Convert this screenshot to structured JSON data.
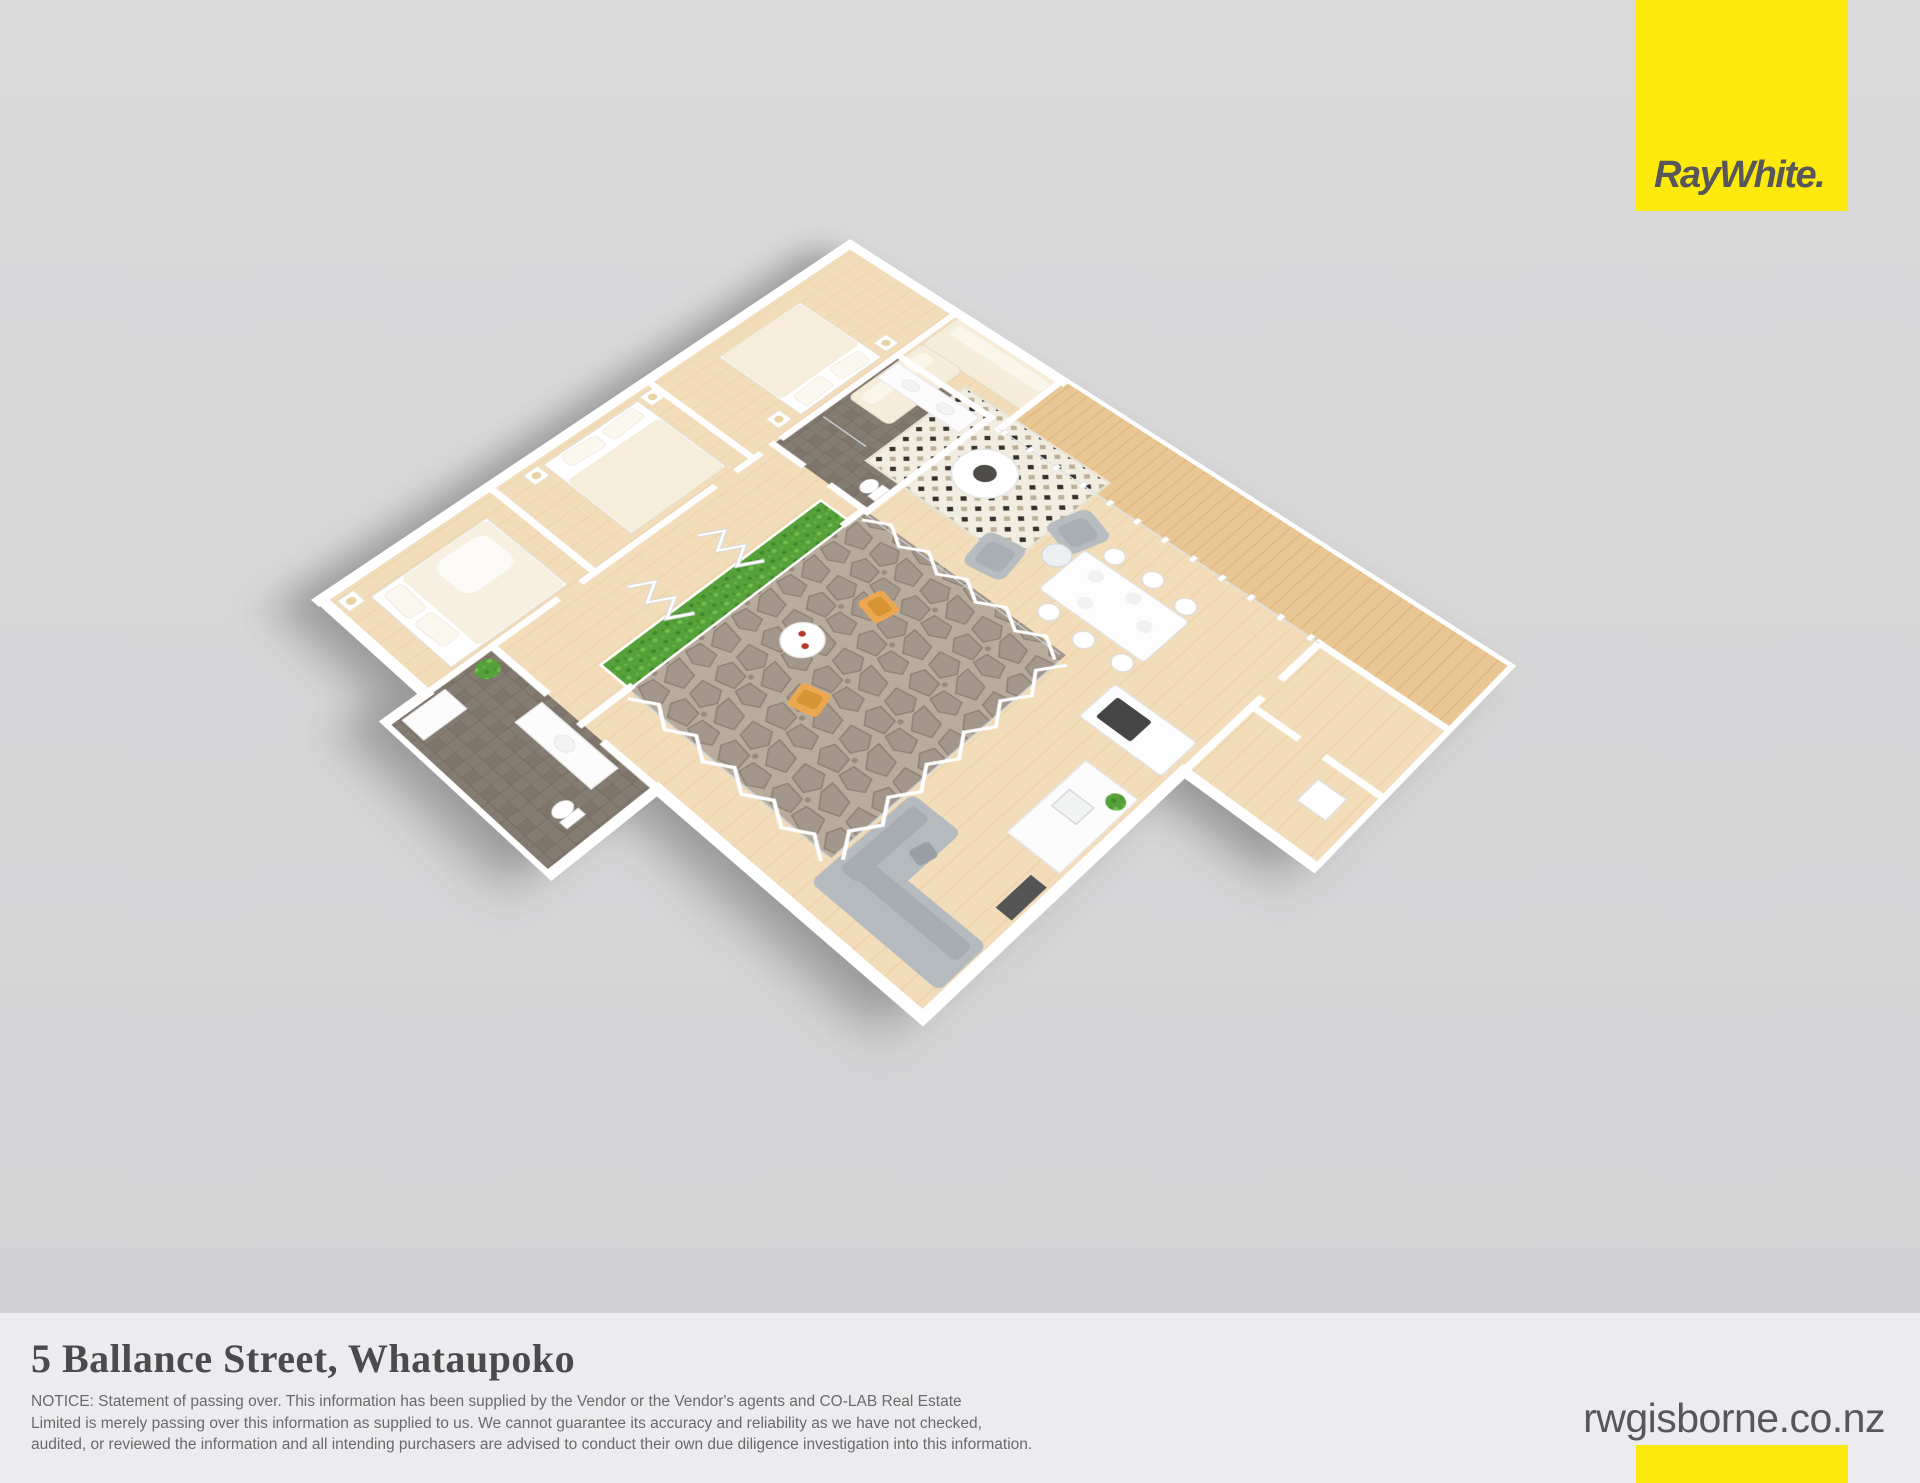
{
  "page": {
    "width": 1920,
    "height": 1483
  },
  "branding": {
    "logo_text": "RayWhite.",
    "website": "rwgisborne.co.nz"
  },
  "footer": {
    "title": "5 Ballance Street, Whataupoko",
    "notice_lines": [
      "NOTICE: Statement of passing over. This information has been supplied by the Vendor or the Vendor's agents and CO-LAB Real Estate",
      "Limited is merely passing over this information as supplied to us. We cannot guarantee its accuracy and reliability as we have not checked,",
      "audited, or reviewed the information and all intending purchasers are advised to conduct their own due diligence investigation into this information."
    ]
  },
  "colors": {
    "brand_yellow": "#fde90b",
    "logo_gray": "#57565a",
    "title_gray": "#4b4b4d",
    "notice_gray": "#6a6a6c",
    "footer_bg": "#ececee",
    "bg_top": "#dadadb",
    "bg_bottom": "#d2d2d4",
    "wood_base": "#f2dcba",
    "wood_line": "#e7cda2",
    "deck_base": "#e9c795",
    "deck_line": "#d7b078",
    "tile_base": "#847b71",
    "tile_line": "#746b61",
    "stone_base": "#b8ab9c",
    "stone_dark": "#a3968a",
    "stone_edge": "#8c8073",
    "hedge_green": "#57a13b",
    "chair_orange": "#eca851",
    "sofa_gray": "#b4babe",
    "bed_cream": "#f6eedb"
  },
  "floorplan": {
    "type": "3d-render-floor-plan",
    "rooms": [
      "open-plan living, dining and kitchen",
      "timber deck with glass balustrade",
      "internal stone courtyard with bifold doors",
      "bedroom 1",
      "bedroom 2",
      "bedroom 3",
      "bathroom",
      "second bathroom",
      "hallway",
      "utility wing"
    ],
    "furnishings": [
      "cream corner sofa",
      "patterned rug with round coffee table",
      "two grey armchairs",
      "six-seat dining table",
      "kitchen island with cooktop",
      "grey corner sofa",
      "double beds with bedside tables and lamps",
      "orange cafe chairs with round table",
      "green hedge planter",
      "potted plants"
    ]
  }
}
